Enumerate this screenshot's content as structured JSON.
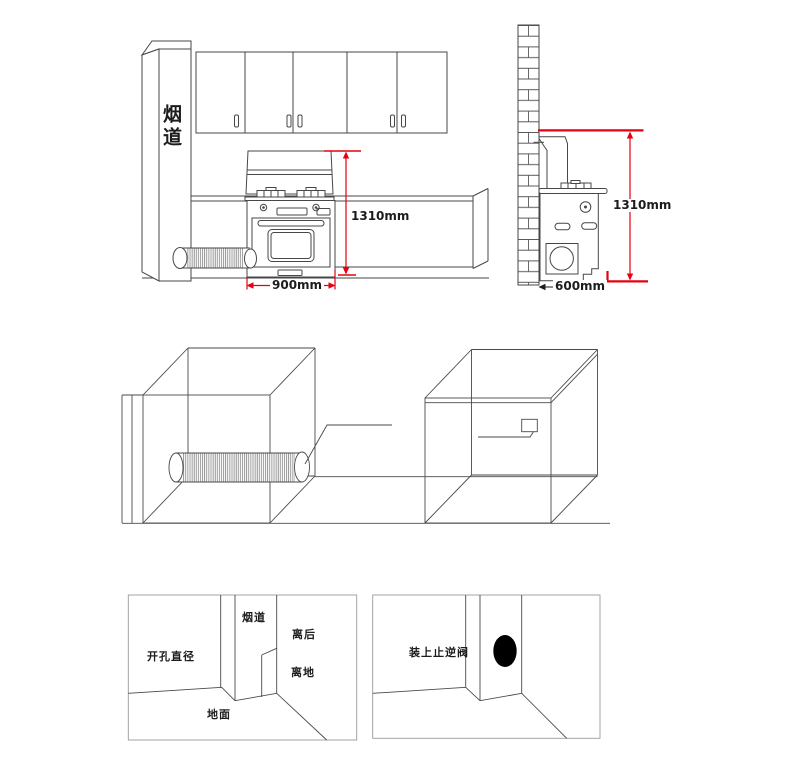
{
  "front_view": {
    "flue_label": "烟道",
    "height_dim": "1310mm",
    "width_dim": "900mm"
  },
  "side_view": {
    "height_dim": "1310mm",
    "depth_dim": "600mm"
  },
  "detail_panel_left": {
    "flue_label": "烟道",
    "rear_clearance_label": "离后",
    "hole_diameter_label": "开孔直径",
    "floor_clearance_label": "离地",
    "ground_label": "地面"
  },
  "detail_panel_right": {
    "check_valve_label": "装上止逆阀"
  },
  "colors": {
    "line": "#474747",
    "dimension_red": "#e60012",
    "panel_border": "#9a9a9a",
    "valve_hole_fill": "#000000"
  }
}
